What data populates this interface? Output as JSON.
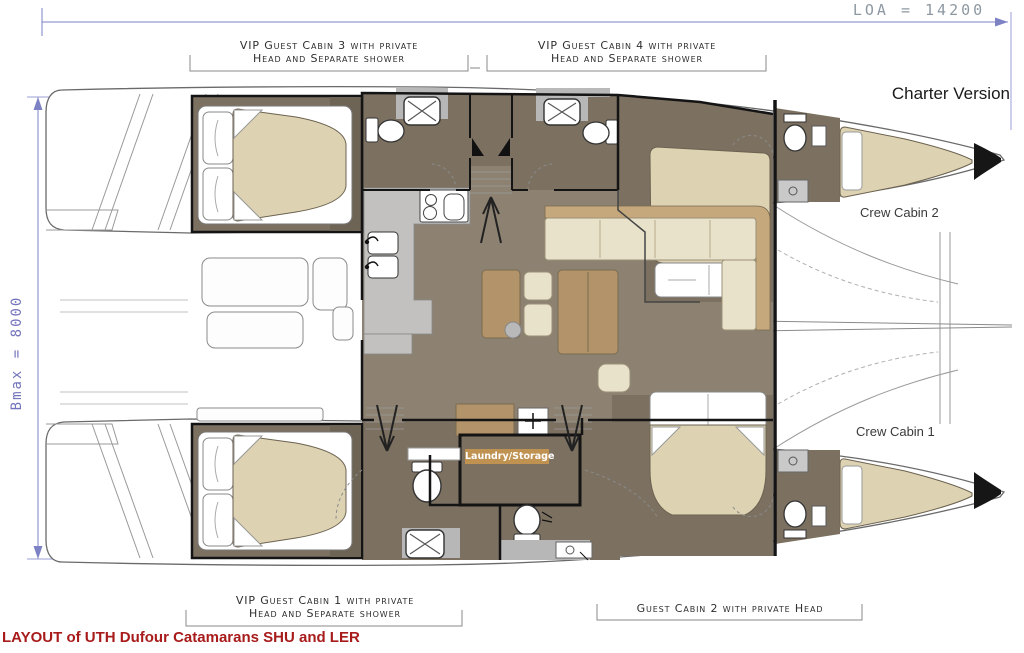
{
  "annotations": {
    "loa": "LOA = 14200",
    "bmax": "Bmax = 8000",
    "charter_version": "Charter Version",
    "caption": "LAYOUT of UTH Dufour Catamarans SHU and LER"
  },
  "cabin_labels": {
    "vip3_line1": "VIP Guest Cabin 3 with private",
    "vip3_line2": "Head and Separate shower",
    "vip4_line1": "VIP Guest Cabin 4 with private",
    "vip4_line2": "Head and Separate shower",
    "vip1_line1": "VIP Guest Cabin 1 with private",
    "vip1_line2": "Head and Separate shower",
    "guest2": "Guest Cabin 2 with private Head",
    "crew1": "Crew Cabin 1",
    "crew2": "Crew Cabin 2",
    "laundry": "Laundry/Storage"
  },
  "colors": {
    "dimension_blue": "#7d82c4",
    "loa_gray": "#8d98a2",
    "caption_red": "#a81b1b",
    "laundry_bar": "#c49551",
    "floor_dark": "#7c7161",
    "floor_saloon": "#8d8271",
    "mattress_cream": "#ddd2b2",
    "wood_tan": "#b3946a",
    "cushion_cream": "#e9e2cb",
    "counter_gray": "#c2c1bf"
  }
}
